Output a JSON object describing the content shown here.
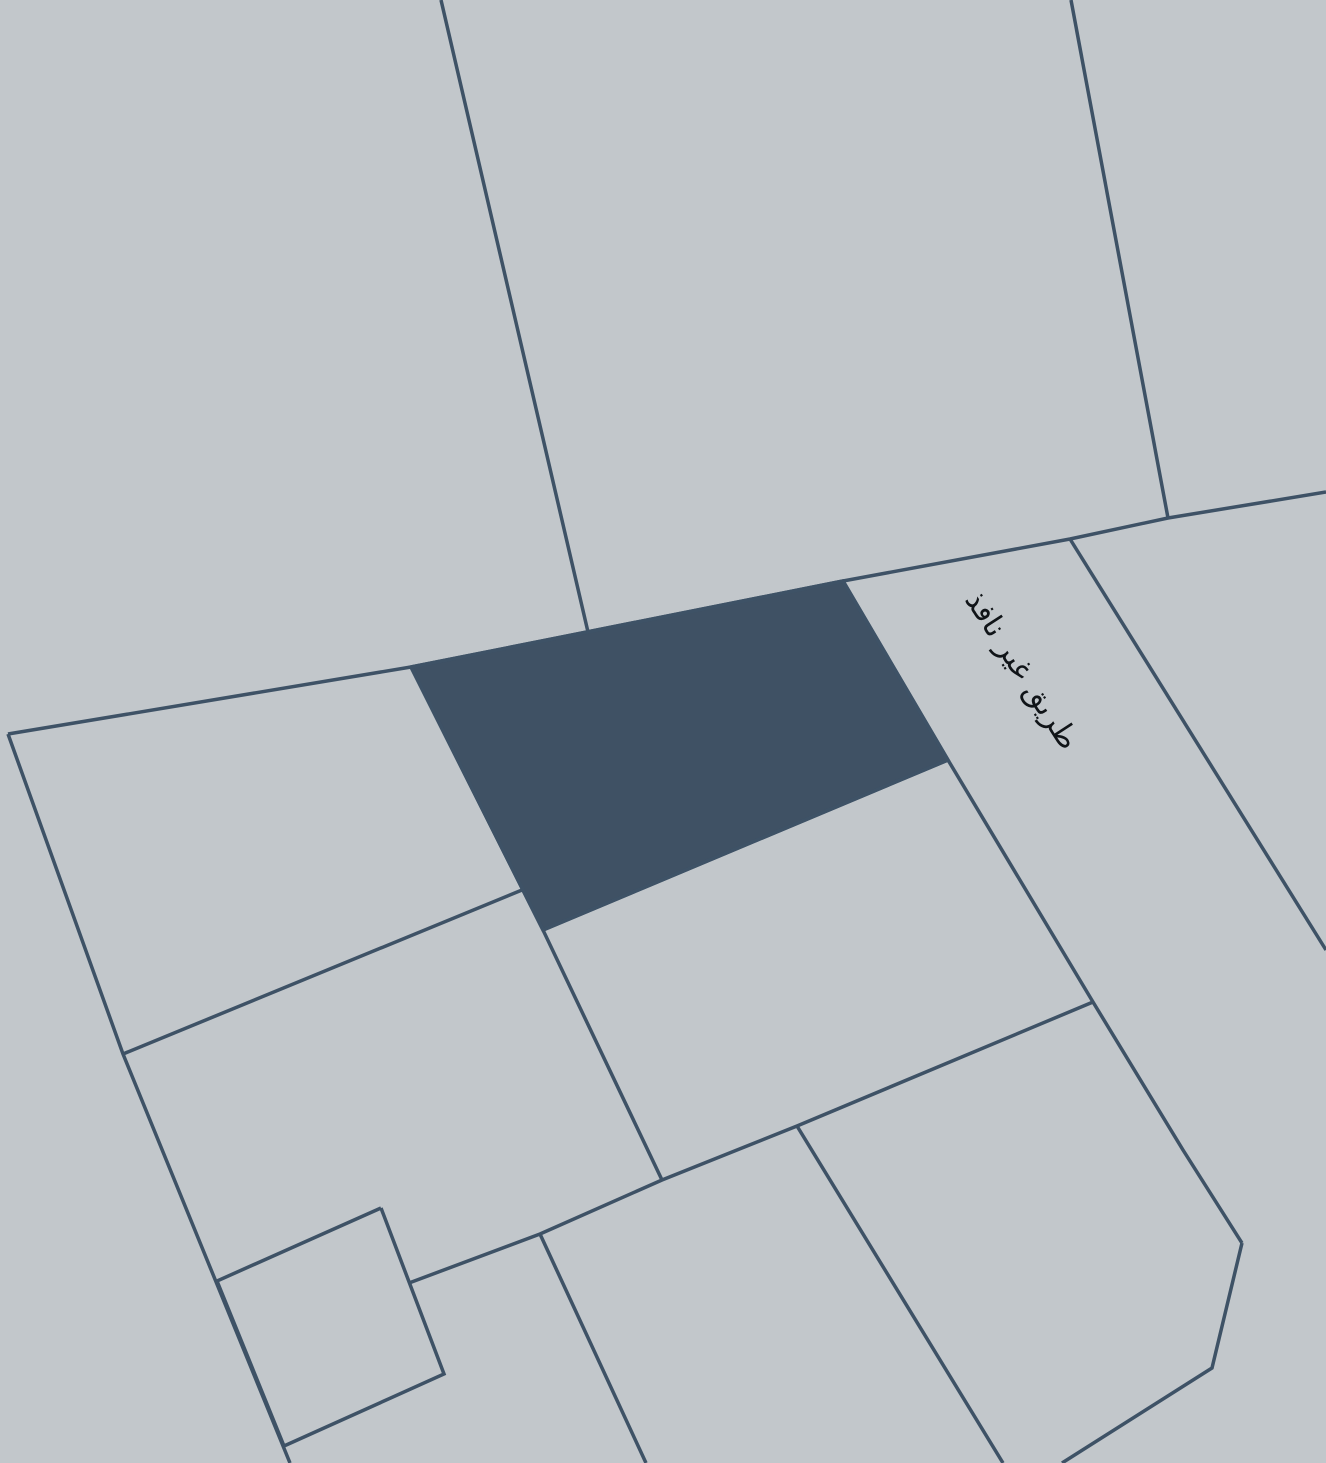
{
  "map": {
    "background_color": "#c2c7cb",
    "line_color": "#3e5266",
    "line_width": 3.5,
    "selected_parcel": {
      "fill_color": "#3f5164",
      "points": [
        [
          411,
          667
        ],
        [
          843,
          581
        ],
        [
          948,
          760
        ],
        [
          543,
          930
        ]
      ]
    },
    "boundaries": [
      {
        "name": "top-left-parcel-divider",
        "points": [
          [
            441,
            0
          ],
          [
            588,
            632
          ]
        ]
      },
      {
        "name": "top-right-parcel-divider",
        "points": [
          [
            1071,
            0
          ],
          [
            1168,
            518
          ]
        ]
      },
      {
        "name": "street-upper-boundary",
        "points": [
          [
            8,
            734
          ],
          [
            411,
            667
          ],
          [
            843,
            581
          ],
          [
            1070,
            539
          ],
          [
            1168,
            518
          ],
          [
            1326,
            492
          ]
        ]
      },
      {
        "name": "west-boundary",
        "points": [
          [
            8,
            734
          ],
          [
            123,
            1054
          ],
          [
            290,
            1463
          ]
        ]
      },
      {
        "name": "left-parcels-divider",
        "points": [
          [
            123,
            1054
          ],
          [
            522,
            890
          ]
        ]
      },
      {
        "name": "center-west-boundary",
        "points": [
          [
            411,
            667
          ],
          [
            543,
            930
          ],
          [
            662,
            1180
          ]
        ]
      },
      {
        "name": "selected-parcel-south-edge",
        "points": [
          [
            543,
            930
          ],
          [
            948,
            760
          ]
        ]
      },
      {
        "name": "road-west-edge",
        "points": [
          [
            843,
            581
          ],
          [
            948,
            760
          ],
          [
            1093,
            1002
          ],
          [
            1183,
            1150
          ],
          [
            1242,
            1243
          ]
        ]
      },
      {
        "name": "road-east-edge",
        "points": [
          [
            1070,
            539
          ],
          [
            1326,
            950
          ]
        ]
      },
      {
        "name": "south-block-boundary",
        "points": [
          [
            1093,
            1002
          ],
          [
            797,
            1126
          ],
          [
            662,
            1180
          ],
          [
            540,
            1234
          ],
          [
            409,
            1283
          ]
        ]
      },
      {
        "name": "southeast-parcel-west-edge",
        "points": [
          [
            797,
            1126
          ],
          [
            1003,
            1463
          ]
        ]
      },
      {
        "name": "southeast-parcel-south-edge",
        "points": [
          [
            1242,
            1243
          ],
          [
            1212,
            1368
          ],
          [
            1062,
            1463
          ]
        ]
      },
      {
        "name": "south-parcels-divider",
        "points": [
          [
            540,
            1234
          ],
          [
            646,
            1463
          ]
        ]
      },
      {
        "name": "small-southwest-parcel",
        "points": [
          [
            381,
            1208
          ],
          [
            217,
            1281
          ],
          [
            284,
            1446
          ],
          [
            444,
            1374
          ],
          [
            381,
            1208
          ]
        ]
      }
    ],
    "road_label": {
      "text": "طريق غير نافذ",
      "x": 1021,
      "y": 671,
      "rotation": 57,
      "font_size": 30,
      "color": "#101418"
    }
  }
}
